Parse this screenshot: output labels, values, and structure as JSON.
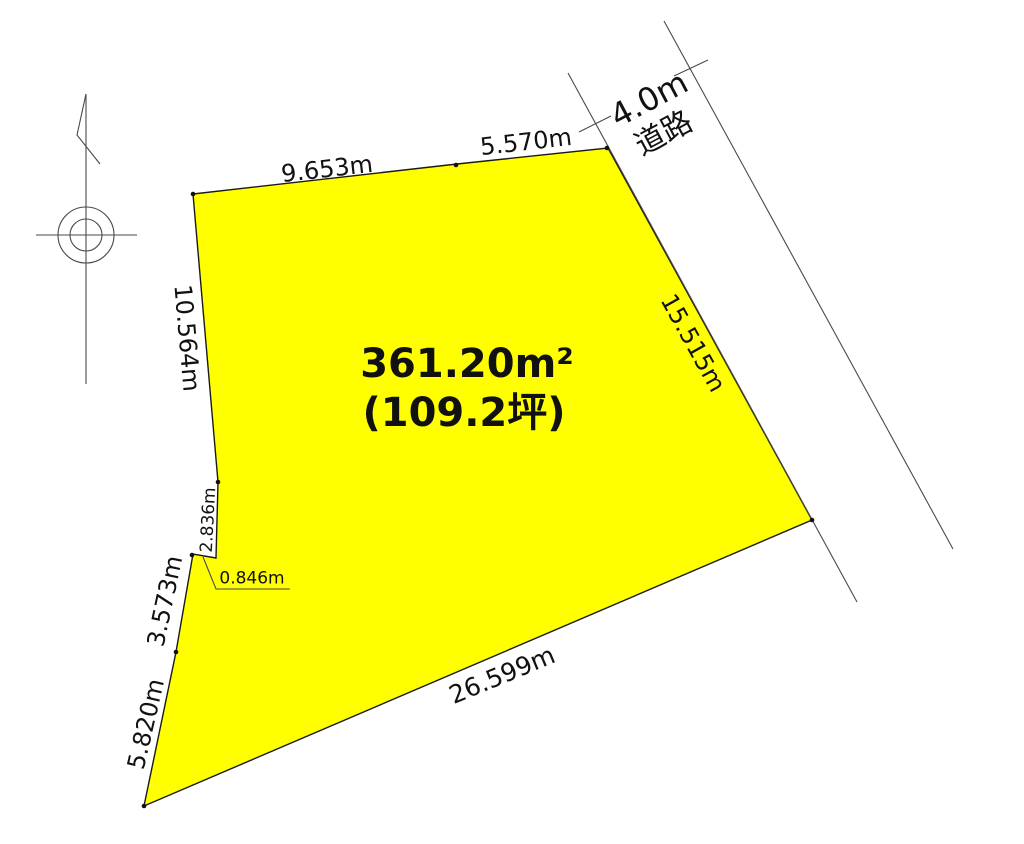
{
  "drawing": {
    "type": "land-plot-survey",
    "area": {
      "square_meters": "361.20m²",
      "tsubo": "(109.2坪)"
    },
    "road": {
      "width": "4.0m",
      "name": "道路"
    },
    "dimensions": {
      "top_left_edge": "9.653m",
      "top_right_edge": "5.570m",
      "right_edge": "15.515m",
      "left_upper_edge": "10.564m",
      "left_small_edge": "2.836m",
      "jog_edge": "0.846m",
      "left_lower_edge": "3.573m",
      "left_bottom_edge": "5.820m",
      "bottom_edge": "26.599m"
    },
    "colors": {
      "plot_fill": "#ffff00",
      "outline": "#1a1a1a",
      "thin_line": "#4a4a4a",
      "background": "#ffffff",
      "text": "#111111"
    },
    "symbols": {
      "north_marker": "surveyor-north-symbol"
    }
  }
}
